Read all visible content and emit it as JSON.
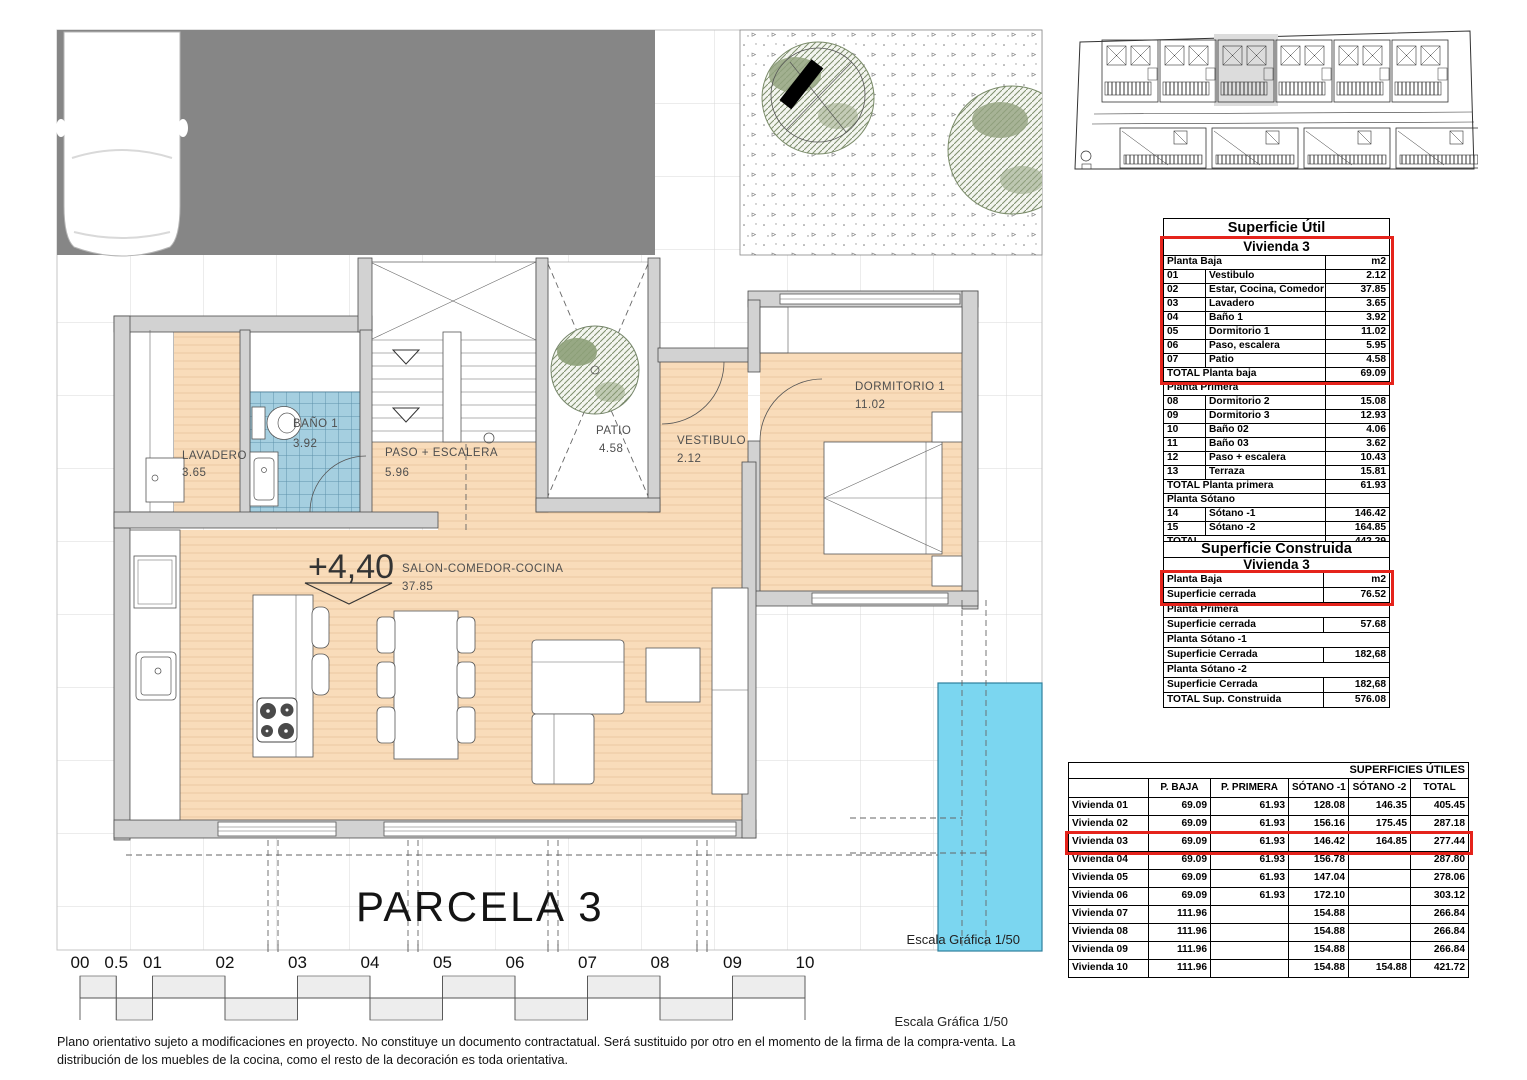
{
  "plan": {
    "parcela_label": "PARCELA 3",
    "elevation_marker": "+4,40",
    "escala_plan": "Escala Gráfica 1/50",
    "escala_bottom": "Escala Gráfica 1/50",
    "rooms": [
      {
        "id": "lavadero",
        "name": "LAVADERO",
        "area": "3.65"
      },
      {
        "id": "bano1",
        "name": "BAÑO 1",
        "area": "3.92"
      },
      {
        "id": "paso",
        "name": "PASO + ESCALERA",
        "area": "5.96"
      },
      {
        "id": "patio",
        "name": "PATIO",
        "area": "4.58"
      },
      {
        "id": "vestibulo",
        "name": "VESTIBULO",
        "area": "2.12"
      },
      {
        "id": "dormitorio1",
        "name": "DORMITORIO 1",
        "area": "11.02"
      },
      {
        "id": "salon",
        "name": "SALON-COMEDOR-COCINA",
        "area": "37.85"
      }
    ]
  },
  "scale_bar": {
    "labels": [
      "00",
      "0.5",
      "01",
      "02",
      "03",
      "04",
      "05",
      "06",
      "07",
      "08",
      "09",
      "10"
    ]
  },
  "tables": {
    "superficie_util": {
      "title": "Superficie Útil",
      "subtitle": "Vivienda 3",
      "rows": [
        {
          "t": "head",
          "label": "Planta Baja",
          "value": "m2"
        },
        {
          "t": "item",
          "num": "01",
          "label": "Vestibulo",
          "value": "2.12"
        },
        {
          "t": "item",
          "num": "02",
          "label": "Estar, Cocina, Comedor",
          "value": "37.85"
        },
        {
          "t": "item",
          "num": "03",
          "label": "Lavadero",
          "value": "3.65"
        },
        {
          "t": "item",
          "num": "04",
          "label": "Baño 1",
          "value": "3.92"
        },
        {
          "t": "item",
          "num": "05",
          "label": "Dormitorio 1",
          "value": "11.02"
        },
        {
          "t": "item",
          "num": "06",
          "label": "Paso, escalera",
          "value": "5.95"
        },
        {
          "t": "item",
          "num": "07",
          "label": "Patio",
          "value": "4.58"
        },
        {
          "t": "total",
          "label": "TOTAL Planta baja",
          "value": "69.09"
        },
        {
          "t": "head",
          "label": "Planta Primera",
          "value": ""
        },
        {
          "t": "item",
          "num": "08",
          "label": "Dormitorio 2",
          "value": "15.08"
        },
        {
          "t": "item",
          "num": "09",
          "label": "Dormitorio 3",
          "value": "12.93"
        },
        {
          "t": "item",
          "num": "10",
          "label": "Baño 02",
          "value": "4.06"
        },
        {
          "t": "item",
          "num": "11",
          "label": "Baño 03",
          "value": "3.62"
        },
        {
          "t": "item",
          "num": "12",
          "label": "Paso + escalera",
          "value": "10.43"
        },
        {
          "t": "item",
          "num": "13",
          "label": "Terraza",
          "value": "15.81"
        },
        {
          "t": "total",
          "label": "TOTAL Planta primera",
          "value": "61.93"
        },
        {
          "t": "head",
          "label": "Planta Sótano",
          "value": ""
        },
        {
          "t": "item",
          "num": "14",
          "label": "Sótano -1",
          "value": "146.42"
        },
        {
          "t": "item",
          "num": "15",
          "label": "Sótano -2",
          "value": "164.85"
        },
        {
          "t": "total",
          "label": "TOTAL",
          "value": "442.29"
        }
      ]
    },
    "superficie_construida": {
      "title": "Superficie Construida",
      "subtitle": "Vivienda 3",
      "rows": [
        {
          "label": "Planta Baja",
          "value": "m2"
        },
        {
          "label": "Superficie cerrada",
          "value": "76.52"
        },
        {
          "label": "Planta Primera",
          "value": null
        },
        {
          "label": "Superficie cerrada",
          "value": "57.68"
        },
        {
          "label": "Planta Sótano -1",
          "value": null
        },
        {
          "label": "Superficie Cerrada",
          "value": "182,68"
        },
        {
          "label": "Planta Sótano -2",
          "value": null
        },
        {
          "label": "Superficie Cerrada",
          "value": "182,68"
        },
        {
          "label": "TOTAL Sup. Construida",
          "value": "576.08"
        }
      ]
    },
    "superficies_utiles": {
      "title": "SUPERFICIES ÚTILES",
      "columns": [
        "",
        "P. BAJA",
        "P. PRIMERA",
        "SÓTANO -1",
        "SÓTANO -2",
        "TOTAL"
      ],
      "rows": [
        {
          "label": "Vivienda 01",
          "values": [
            "69.09",
            "61.93",
            "128.08",
            "146.35",
            "405.45"
          ],
          "highlight": false
        },
        {
          "label": "Vivienda 02",
          "values": [
            "69.09",
            "61.93",
            "156.16",
            "175.45",
            "287.18"
          ],
          "highlight": false
        },
        {
          "label": "Vivienda 03",
          "values": [
            "69.09",
            "61.93",
            "146.42",
            "164.85",
            "277.44"
          ],
          "highlight": true
        },
        {
          "label": "Vivienda 04",
          "values": [
            "69.09",
            "61.93",
            "156.78",
            "",
            "287.80"
          ],
          "highlight": false
        },
        {
          "label": "Vivienda 05",
          "values": [
            "69.09",
            "61.93",
            "147.04",
            "",
            "278.06"
          ],
          "highlight": false
        },
        {
          "label": "Vivienda 06",
          "values": [
            "69.09",
            "61.93",
            "172.10",
            "",
            "303.12"
          ],
          "highlight": false
        },
        {
          "label": "Vivienda 07",
          "values": [
            "111.96",
            "",
            "154.88",
            "",
            "266.84"
          ],
          "highlight": false
        },
        {
          "label": "Vivienda 08",
          "values": [
            "111.96",
            "",
            "154.88",
            "",
            "266.84"
          ],
          "highlight": false
        },
        {
          "label": "Vivienda 09",
          "values": [
            "111.96",
            "",
            "154.88",
            "",
            "266.84"
          ],
          "highlight": false
        },
        {
          "label": "Vivienda 10",
          "values": [
            "111.96",
            "",
            "154.88",
            "154.88",
            "421.72"
          ],
          "highlight": false
        }
      ]
    }
  },
  "footer": {
    "line1": "Plano orientativo sujeto a modificaciones en proyecto. No constituye un documento contractatual. Será sustituido por otro en el momento de la firma de la compra-venta. La",
    "line2": "distribución de los muebles de la cocina, como el resto de la decoración es toda orientativa."
  },
  "colors": {
    "highlight_red": "#e5231b",
    "pool_cyan": "#7bd6f0",
    "floor_peach": "#f9dcba",
    "tile_blue": "#a5cfe0",
    "driveway_gray": "#868686",
    "wall_gray": "#d2d2d2"
  }
}
